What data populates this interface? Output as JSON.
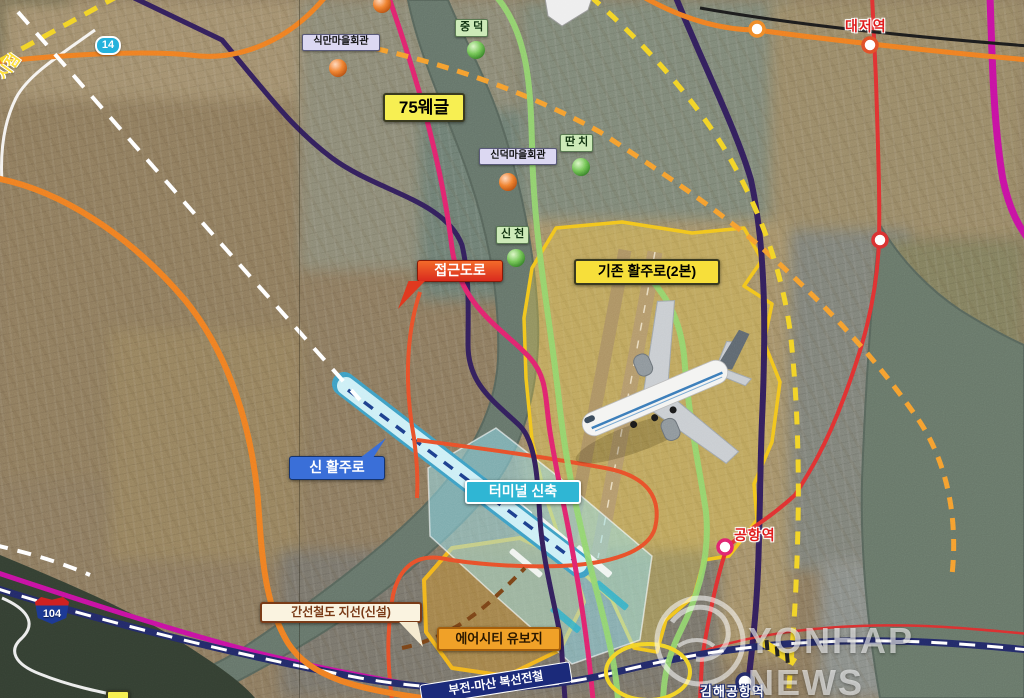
{
  "map": {
    "region_labels": {
      "sikman": "식만마을회관",
      "jungdeok": "중 덕",
      "sindeok": "신덕마을회관",
      "ttanchi": "딴 치",
      "sincheon": "신 천"
    },
    "route_badges": {
      "route14": "14",
      "route104": "104",
      "route75": "75웨글"
    },
    "plan_labels": {
      "access_road": "접근도로",
      "existing_runway": "기존 활주로(2본)",
      "new_runway": "신 활주로",
      "new_terminal": "터미널 신축",
      "rail_branch": "간선철도 지선(신설)",
      "aircity_reserve": "에어시티 유보지",
      "bujeon_masan_line": "부전-마산 복선전철"
    },
    "stations": {
      "daejeo": "대저역",
      "airport": "공항역",
      "gimhae_airport": "김해공항역"
    },
    "edge_note": "시점",
    "watermark": {
      "agency": "YONHAP NEWS"
    }
  },
  "colors": {
    "orange_road": "#ef7f22",
    "orange_dashed": "#f59f2f",
    "yellow_dashed": "#f2d327",
    "green_line": "#92d66e",
    "crimson_line": "#e0256e",
    "red_line": "#e03131",
    "magenta_line": "#c712a2",
    "navy_line": "#33205c",
    "railway_navy": "#232a68",
    "new_runway_cyan": "#bfe9f2",
    "airport_zone_yellow": "#f2c51d",
    "aircity_gold": "#e8a01f",
    "access_red": "#e8502a"
  }
}
